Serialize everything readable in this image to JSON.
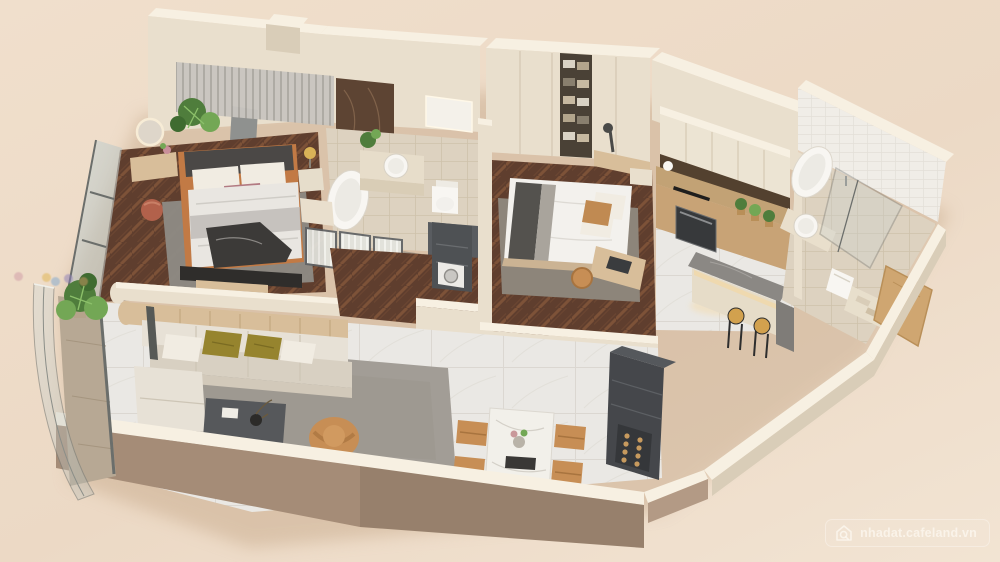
{
  "watermark": {
    "text": "nhadat.cafeland.vn",
    "icon": "house-search-icon"
  },
  "brand_dots": [
    {
      "x": 14,
      "y": 272,
      "color": "#cf9aa5"
    },
    {
      "x": 42,
      "y": 273,
      "color": "#e0b44e"
    },
    {
      "x": 51,
      "y": 277,
      "color": "#7da7cf"
    },
    {
      "x": 64,
      "y": 274,
      "color": "#8d7fba"
    },
    {
      "x": 79,
      "y": 277,
      "color": "#cf9a64"
    }
  ],
  "palette": {
    "bg_top": "#f0dfcc",
    "bg_mid": "#ecd9c5",
    "bg_bottom": "#f2e4d3",
    "wall_face": "#e9dfcd",
    "wall_top": "#f7f0e2",
    "wall_shade": "#d9cdb8",
    "front_taupe": "#a58c77",
    "front_taupe_dark": "#97806c",
    "wood_floor": "#5f3e2e",
    "wood_line": "#7d5238",
    "marble_floor": "#eae8e4",
    "marble_line": "#dbd7d1",
    "bath_floor": "#ddd2c0",
    "bath_line": "#cfc2ab",
    "white_tile": "#f0ede7",
    "rug_living": "#a29d96",
    "rug_bedroom": "#8e8b85",
    "sofa_light": "#e7e1d6",
    "sofa_shadow": "#d8d0c2",
    "pillow_olive": "#96842e",
    "pillow_white": "#f1ece2",
    "accent_tan": "#c78e55",
    "wood_panel": "#d8be9a",
    "console_dark": "#45474b",
    "shower_dark": "#595c60",
    "charcoal": "#3c3a38",
    "bed_frame_tan": "#c27a45",
    "terracotta": "#b2614b",
    "plant_dark": "#4f7d3c",
    "plant_light": "#73a755",
    "fixture_white": "#f8f6f2",
    "backsplash_dark": "#53412f",
    "marble_wall_panel": "#5d4433",
    "island_gray": "#8b8884",
    "glass_tint": "#ccd3d0",
    "glass_frame": "#6b6e6b",
    "glow": "#f6d79b",
    "watermark_text": "rgba(252,247,240,0.78)",
    "shadow_color": "#c8ab8d"
  },
  "scene": {
    "type": "3d-apartment-floor-plan",
    "view": "isometric-top-down-render",
    "rooms": [
      {
        "id": "master-bedroom",
        "furniture": [
          "double-bed",
          "upholstered-headboard",
          "area-rug",
          "vanity-table",
          "illuminated-round-mirror",
          "terracotta-pouf",
          "nightstand",
          "table-lamp",
          "wall-slat-panel",
          "marble-wall-panel",
          "wall-mounted-tv",
          "window-wall",
          "potted-plant"
        ]
      },
      {
        "id": "ensuite-bathroom",
        "furniture": [
          "freestanding-bathtub",
          "vanity-counter",
          "round-basin",
          "mirror-cabinet",
          "toilet",
          "walk-in-shower",
          "fluted-glass-partition",
          "potted-plant"
        ]
      },
      {
        "id": "walkthrough-closet",
        "furniture": [
          "storage-cabinets",
          "utility-closet",
          "washing-machine"
        ]
      },
      {
        "id": "bedroom-2",
        "furniture": [
          "double-bed",
          "area-rug",
          "wardrobe-with-open-shelves",
          "dressing-desk",
          "desk-lamp",
          "work-desk",
          "laptop",
          "desk-chair",
          "nightstand"
        ]
      },
      {
        "id": "kitchen",
        "furniture": [
          "upper-cabinets",
          "stone-backsplash",
          "induction-hob",
          "built-in-oven",
          "base-cabinets",
          "island-breakfast-bar",
          "bar-stools",
          "potted-herbs",
          "kettle"
        ],
        "bar_stool_count": 2
      },
      {
        "id": "bathroom-2",
        "furniture": [
          "freestanding-bathtub",
          "round-basin",
          "vanity-counter",
          "glass-shower-enclosure",
          "toilet",
          "towel-shelf",
          "wooden-door"
        ]
      },
      {
        "id": "living-room",
        "furniture": [
          "l-shaped-sectional-sofa",
          "throw-pillows",
          "area-rug",
          "coffee-table",
          "accent-armchair",
          "tv-console",
          "curved-wood-panel",
          "sliding-glass-door"
        ]
      },
      {
        "id": "dining-area",
        "furniture": [
          "marble-dining-table",
          "dining-chairs",
          "centerpiece",
          "wine-cabinet"
        ],
        "chair_count": 4
      },
      {
        "id": "balcony",
        "furniture": [
          "curved-glass-balustrade",
          "potted-plant"
        ]
      }
    ]
  }
}
